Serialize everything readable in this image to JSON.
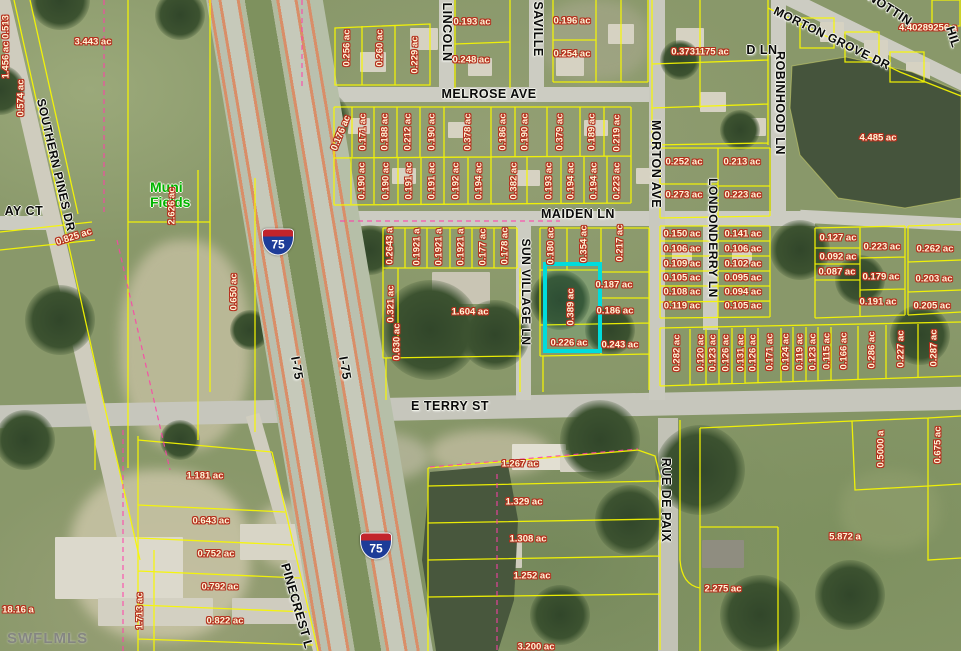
{
  "map": {
    "watermark": "SWFLMLS",
    "colors": {
      "parcel_line": "#f8f800",
      "highlight": "#00dcdc",
      "dashed_boundary": "#ff40a8",
      "acre_text": "#fff6d8",
      "acre_outline": "#b5301e",
      "street_text": "#0a0a0a",
      "landmark_green": "#00b400",
      "shield_blue": "#1d3c98",
      "shield_red": "#c2242c"
    },
    "landmark": {
      "line1": "Muni",
      "line2": "Fields"
    },
    "highlight_parcel": {
      "x": 543,
      "y": 262,
      "w": 59,
      "h": 91,
      "acreage": "0.389 ac"
    },
    "shields": [
      {
        "label": "75",
        "x": 278,
        "y": 242
      },
      {
        "label": "75",
        "x": 376,
        "y": 546
      }
    ],
    "streets": [
      {
        "t": "SOUTHERN PINES DR",
        "x": 56,
        "y": 165,
        "r": 77
      },
      {
        "t": "AY CT",
        "x": 24,
        "y": 211,
        "r": 0
      },
      {
        "t": "LINCOLN",
        "x": 447,
        "y": 32,
        "r": 90
      },
      {
        "t": "SAVILLE",
        "x": 538,
        "y": 29,
        "r": 90
      },
      {
        "t": "MELROSE AVE",
        "x": 489,
        "y": 94,
        "r": 0
      },
      {
        "t": "MAIDEN LN",
        "x": 578,
        "y": 214,
        "r": 0
      },
      {
        "t": "MORTON AVE",
        "x": 656,
        "y": 164,
        "r": 90
      },
      {
        "t": "SUN VILLAGE LN",
        "x": 526,
        "y": 292,
        "r": 90
      },
      {
        "t": "LONDONDERRY LN",
        "x": 713,
        "y": 238,
        "r": 90
      },
      {
        "t": "ROBINHOOD LN",
        "x": 780,
        "y": 103,
        "r": 90
      },
      {
        "t": "MORTON GROVE DR",
        "x": 832,
        "y": 38,
        "r": 26
      },
      {
        "t": "NOTTIN",
        "x": 890,
        "y": 9,
        "r": 33
      },
      {
        "t": "HIL",
        "x": 953,
        "y": 37,
        "r": 72
      },
      {
        "t": "D LN",
        "x": 762,
        "y": 50,
        "r": 0
      },
      {
        "t": "E TERRY ST",
        "x": 450,
        "y": 406,
        "r": 0
      },
      {
        "t": "RUE DE PAIX",
        "x": 666,
        "y": 500,
        "r": 90
      },
      {
        "t": "PINECREST L",
        "x": 297,
        "y": 606,
        "r": 74
      },
      {
        "t": "I-75",
        "x": 297,
        "y": 368,
        "r": 80
      },
      {
        "t": "I-75",
        "x": 345,
        "y": 368,
        "r": 80
      }
    ],
    "acre_labels": [
      {
        "t": "0.513",
        "x": 6,
        "y": 27,
        "r": -90
      },
      {
        "t": "1.456 ac",
        "x": 6,
        "y": 60,
        "r": -90
      },
      {
        "t": "0.574 ac",
        "x": 21,
        "y": 98,
        "r": -90
      },
      {
        "t": "3.443 ac",
        "x": 93,
        "y": 42
      },
      {
        "t": "0.825 ac",
        "x": 74,
        "y": 237,
        "r": -18
      },
      {
        "t": "2.626 ac",
        "x": 172,
        "y": 206,
        "r": -90
      },
      {
        "t": "0.650 ac",
        "x": 234,
        "y": 292,
        "r": -90
      },
      {
        "t": "0.256 ac",
        "x": 347,
        "y": 48,
        "r": -90
      },
      {
        "t": "0.260 ac",
        "x": 380,
        "y": 48,
        "r": -90
      },
      {
        "t": "0.229 ac",
        "x": 415,
        "y": 55,
        "r": -90
      },
      {
        "t": "0.193 ac",
        "x": 472,
        "y": 22
      },
      {
        "t": "0.248 ac",
        "x": 471,
        "y": 60
      },
      {
        "t": "0.196 ac",
        "x": 572,
        "y": 21
      },
      {
        "t": "0.254 ac",
        "x": 572,
        "y": 54
      },
      {
        "t": "0.176 ac",
        "x": 341,
        "y": 133,
        "r": -68
      },
      {
        "t": "0.171 ac",
        "x": 363,
        "y": 132,
        "r": -90
      },
      {
        "t": "0.188 ac",
        "x": 385,
        "y": 132,
        "r": -90
      },
      {
        "t": "0.212 ac",
        "x": 408,
        "y": 132,
        "r": -90
      },
      {
        "t": "0.190 ac",
        "x": 432,
        "y": 132,
        "r": -90
      },
      {
        "t": "0.378 ac",
        "x": 468,
        "y": 132,
        "r": -90
      },
      {
        "t": "0.186 ac",
        "x": 503,
        "y": 132,
        "r": -90
      },
      {
        "t": "0.190 ac",
        "x": 525,
        "y": 132,
        "r": -90
      },
      {
        "t": "0.379 ac",
        "x": 560,
        "y": 132,
        "r": -90
      },
      {
        "t": "0.189 ac",
        "x": 592,
        "y": 132,
        "r": -90
      },
      {
        "t": "0.219 ac",
        "x": 617,
        "y": 133,
        "r": -90
      },
      {
        "t": "0.190 ac",
        "x": 362,
        "y": 181,
        "r": -90
      },
      {
        "t": "0.190 ac",
        "x": 386,
        "y": 181,
        "r": -90
      },
      {
        "t": "0.191 ac",
        "x": 409,
        "y": 181,
        "r": -90
      },
      {
        "t": "0.191 ac",
        "x": 432,
        "y": 181,
        "r": -90
      },
      {
        "t": "0.192 ac",
        "x": 456,
        "y": 181,
        "r": -90
      },
      {
        "t": "0.194 ac",
        "x": 479,
        "y": 181,
        "r": -90
      },
      {
        "t": "0.382 ac",
        "x": 514,
        "y": 181,
        "r": -90
      },
      {
        "t": "0.193 ac",
        "x": 549,
        "y": 181,
        "r": -90
      },
      {
        "t": "0.194 ac",
        "x": 571,
        "y": 181,
        "r": -90
      },
      {
        "t": "0.194 ac",
        "x": 594,
        "y": 181,
        "r": -90
      },
      {
        "t": "0.223 ac",
        "x": 617,
        "y": 181,
        "r": -90
      },
      {
        "t": "0.2643 a",
        "x": 390,
        "y": 246,
        "r": -90
      },
      {
        "t": "0.1921 a",
        "x": 417,
        "y": 247,
        "r": -90
      },
      {
        "t": "0.1921 a",
        "x": 439,
        "y": 247,
        "r": -90
      },
      {
        "t": "0.1921 a",
        "x": 461,
        "y": 247,
        "r": -90
      },
      {
        "t": "0.177 ac",
        "x": 483,
        "y": 247,
        "r": -90
      },
      {
        "t": "0.178 ac",
        "x": 505,
        "y": 246,
        "r": -90
      },
      {
        "t": "0.180 ac",
        "x": 551,
        "y": 246,
        "r": -90
      },
      {
        "t": "0.354 ac",
        "x": 584,
        "y": 244,
        "r": -90
      },
      {
        "t": "0.217 ac",
        "x": 620,
        "y": 243,
        "r": -90
      },
      {
        "t": "0.321 ac",
        "x": 391,
        "y": 304,
        "r": -90
      },
      {
        "t": "1.604 ac",
        "x": 470,
        "y": 312
      },
      {
        "t": "0.389 ac",
        "x": 571,
        "y": 307,
        "r": -90
      },
      {
        "t": "0.187 ac",
        "x": 614,
        "y": 285
      },
      {
        "t": "0.186 ac",
        "x": 615,
        "y": 311
      },
      {
        "t": "0.226 ac",
        "x": 569,
        "y": 343
      },
      {
        "t": "0.243 ac",
        "x": 620,
        "y": 345
      },
      {
        "t": "0.630 ac",
        "x": 397,
        "y": 342,
        "r": -90
      },
      {
        "t": "0.252 ac",
        "x": 684,
        "y": 162
      },
      {
        "t": "0.273 ac",
        "x": 684,
        "y": 195
      },
      {
        "t": "0.213 ac",
        "x": 742,
        "y": 162
      },
      {
        "t": "0.223 ac",
        "x": 743,
        "y": 195
      },
      {
        "t": "0.150 ac",
        "x": 682,
        "y": 234
      },
      {
        "t": "0.106 ac",
        "x": 682,
        "y": 249
      },
      {
        "t": "0.109 ac",
        "x": 682,
        "y": 264
      },
      {
        "t": "0.105 ac",
        "x": 682,
        "y": 278
      },
      {
        "t": "0.108 ac",
        "x": 682,
        "y": 292
      },
      {
        "t": "0.119 ac",
        "x": 682,
        "y": 306
      },
      {
        "t": "0.141 ac",
        "x": 743,
        "y": 234
      },
      {
        "t": "0.106 ac",
        "x": 743,
        "y": 249
      },
      {
        "t": "0.102 ac",
        "x": 743,
        "y": 264
      },
      {
        "t": "0.095 ac",
        "x": 743,
        "y": 278
      },
      {
        "t": "0.094 ac",
        "x": 743,
        "y": 292
      },
      {
        "t": "0.105 ac",
        "x": 743,
        "y": 306
      },
      {
        "t": "0.127 ac",
        "x": 838,
        "y": 238
      },
      {
        "t": "0.092 ac",
        "x": 838,
        "y": 257
      },
      {
        "t": "0.087 ac",
        "x": 837,
        "y": 272
      },
      {
        "t": "0.223 ac",
        "x": 882,
        "y": 247
      },
      {
        "t": "0.179 ac",
        "x": 881,
        "y": 277
      },
      {
        "t": "0.191 ac",
        "x": 878,
        "y": 302
      },
      {
        "t": "0.262 ac",
        "x": 935,
        "y": 249
      },
      {
        "t": "0.203 ac",
        "x": 934,
        "y": 279
      },
      {
        "t": "0.205 ac",
        "x": 932,
        "y": 306
      },
      {
        "t": "0.3731175 ac",
        "x": 700,
        "y": 52
      },
      {
        "t": "4.40289256 a",
        "x": 928,
        "y": 28
      },
      {
        "t": "4.485 ac",
        "x": 878,
        "y": 138
      },
      {
        "t": "0.282 ac",
        "x": 677,
        "y": 353,
        "r": -90
      },
      {
        "t": "0.120 ac",
        "x": 701,
        "y": 353,
        "r": -90
      },
      {
        "t": "0.123 ac",
        "x": 713,
        "y": 353,
        "r": -90
      },
      {
        "t": "0.126 ac",
        "x": 726,
        "y": 353,
        "r": -90
      },
      {
        "t": "0.131 ac",
        "x": 741,
        "y": 353,
        "r": -90
      },
      {
        "t": "0.126 ac",
        "x": 753,
        "y": 353,
        "r": -90
      },
      {
        "t": "0.171 ac",
        "x": 770,
        "y": 352,
        "r": -90
      },
      {
        "t": "0.124 ac",
        "x": 786,
        "y": 352,
        "r": -90
      },
      {
        "t": "0.119 ac",
        "x": 800,
        "y": 352,
        "r": -90
      },
      {
        "t": "0.123 ac",
        "x": 813,
        "y": 352,
        "r": -90
      },
      {
        "t": "0.115 ac",
        "x": 827,
        "y": 351,
        "r": -90
      },
      {
        "t": "0.166 ac",
        "x": 844,
        "y": 351,
        "r": -90
      },
      {
        "t": "0.286 ac",
        "x": 872,
        "y": 350,
        "r": -90
      },
      {
        "t": "0.227 ac",
        "x": 901,
        "y": 349,
        "r": -90
      },
      {
        "t": "0.287 ac",
        "x": 934,
        "y": 348,
        "r": -90
      },
      {
        "t": "1.267 ac",
        "x": 520,
        "y": 464
      },
      {
        "t": "1.329 ac",
        "x": 524,
        "y": 502
      },
      {
        "t": "1.308 ac",
        "x": 528,
        "y": 539
      },
      {
        "t": "1.252 ac",
        "x": 532,
        "y": 576
      },
      {
        "t": "3.200 ac",
        "x": 536,
        "y": 647
      },
      {
        "t": "2.275 ac",
        "x": 723,
        "y": 589
      },
      {
        "t": "5.872 a",
        "x": 845,
        "y": 537
      },
      {
        "t": "0.5000 a",
        "x": 881,
        "y": 449,
        "r": -90
      },
      {
        "t": "0.675 ac",
        "x": 938,
        "y": 445,
        "r": -90
      },
      {
        "t": "1.181 ac",
        "x": 205,
        "y": 476
      },
      {
        "t": "0.643 ac",
        "x": 211,
        "y": 521
      },
      {
        "t": "0.752 ac",
        "x": 216,
        "y": 554
      },
      {
        "t": "0.792 ac",
        "x": 220,
        "y": 587
      },
      {
        "t": "0.822 ac",
        "x": 225,
        "y": 621
      },
      {
        "t": "1.713 ac",
        "x": 140,
        "y": 611,
        "r": -90
      },
      {
        "t": "18.16 a",
        "x": 18,
        "y": 610
      }
    ]
  }
}
